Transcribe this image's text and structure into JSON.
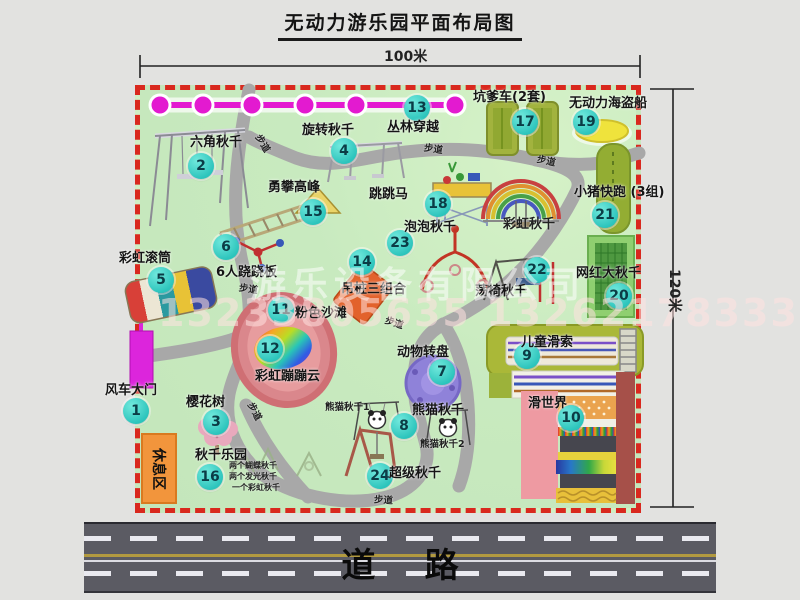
{
  "title": "无动力游乐园平面布局图",
  "dimensions": {
    "width_label": "100米",
    "height_label": "120米"
  },
  "watermark": {
    "company": "游乐设备有限公司",
    "phone": "13233805635 13262178333"
  },
  "road": {
    "label": "道 路"
  },
  "rest_area": {
    "label": "休息区"
  },
  "colors": {
    "border_red": "#d9281e",
    "park_green": "#c8eabf",
    "badge_cyan": "#2cc4bc",
    "path_gray": "#a8a8a8",
    "zipline_magenta": "#e31ad0",
    "gate_magenta": "#dc25dc",
    "rest_area_orange": "#f2953c",
    "road_gray": "#5b5b63"
  },
  "park": {
    "attractions": [
      {
        "num": 1,
        "label": "风车大门",
        "bx": 136,
        "by": 411,
        "lx": 105,
        "ly": 379
      },
      {
        "num": 2,
        "label": "六角秋千",
        "bx": 201,
        "by": 166,
        "lx": 190,
        "ly": 131
      },
      {
        "num": 3,
        "label": "樱花树",
        "bx": 216,
        "by": 422,
        "lx": 186,
        "ly": 391
      },
      {
        "num": 4,
        "label": "旋转秋千",
        "bx": 344,
        "by": 151,
        "lx": 302,
        "ly": 119
      },
      {
        "num": 5,
        "label": "彩虹滚筒",
        "bx": 161,
        "by": 280,
        "lx": 119,
        "ly": 247
      },
      {
        "num": 6,
        "label": "6人跷跷板",
        "bx": 226,
        "by": 247,
        "lx": 216,
        "ly": 261
      },
      {
        "num": 7,
        "label": "动物转盘",
        "bx": 442,
        "by": 372,
        "lx": 397,
        "ly": 341
      },
      {
        "num": 8,
        "label": "熊猫秋千",
        "bx": 404,
        "by": 426,
        "lx": 412,
        "ly": 399
      },
      {
        "num": 9,
        "label": "儿童滑索",
        "bx": 527,
        "by": 356,
        "lx": 521,
        "ly": 331
      },
      {
        "num": 10,
        "label": "滑世界",
        "bx": 571,
        "by": 418,
        "lx": 528,
        "ly": 392
      },
      {
        "num": 11,
        "label": "粉色沙滩",
        "bx": 281,
        "by": 310,
        "lx": 295,
        "ly": 302
      },
      {
        "num": 12,
        "label": "彩虹蹦蹦云",
        "bx": 270,
        "by": 349,
        "lx": 255,
        "ly": 365
      },
      {
        "num": 13,
        "label": "丛林穿越",
        "bx": 417,
        "by": 108,
        "lx": 387,
        "ly": 116
      },
      {
        "num": 14,
        "label": "吊桩三组合",
        "bx": 362,
        "by": 262,
        "lx": 341,
        "ly": 278
      },
      {
        "num": 15,
        "label": "勇攀高峰",
        "bx": 313,
        "by": 212,
        "lx": 268,
        "ly": 176
      },
      {
        "num": 16,
        "label": "秋千乐园",
        "bx": 210,
        "by": 477,
        "lx": 195,
        "ly": 444
      },
      {
        "num": 17,
        "label": "坑爹车(2套)",
        "bx": 525,
        "by": 122,
        "lx": 473,
        "ly": 86
      },
      {
        "num": 18,
        "label": "跳跳马",
        "bx": 438,
        "by": 204,
        "lx": 369,
        "ly": 183
      },
      {
        "num": 19,
        "label": "无动力海盗船",
        "bx": 586,
        "by": 122,
        "lx": 569,
        "ly": 92
      },
      {
        "num": 20,
        "label": "网红大秋千",
        "bx": 619,
        "by": 296,
        "lx": 576,
        "ly": 262
      },
      {
        "num": 21,
        "label": "小猪快跑 (3组)",
        "bx": 605,
        "by": 215,
        "lx": 574,
        "ly": 181
      },
      {
        "num": 22,
        "label": "荡椅秋千",
        "bx": 537,
        "by": 270,
        "lx": 475,
        "ly": 280
      },
      {
        "num": 23,
        "label": "泡泡秋千",
        "bx": 400,
        "by": 243,
        "lx": 404,
        "ly": 216
      },
      {
        "num": 24,
        "label": "超级秋千",
        "bx": 380,
        "by": 476,
        "lx": 389,
        "ly": 462
      }
    ],
    "extra_labels": [
      {
        "text": "彩虹秋千",
        "x": 503,
        "y": 213,
        "rot": 0,
        "fs": 13
      },
      {
        "text": "熊猫秋千1",
        "x": 325,
        "y": 399,
        "rot": 0,
        "fs": 9.5
      },
      {
        "text": "熊猫秋千2",
        "x": 420,
        "y": 436,
        "rot": 0,
        "fs": 9.5
      },
      {
        "text": "两个蝴蝶秋千",
        "x": 229,
        "y": 460,
        "rot": 0,
        "fs": 8
      },
      {
        "text": "两个发光秋千",
        "x": 229,
        "y": 471,
        "rot": 0,
        "fs": 8
      },
      {
        "text": "一个彩虹秋千",
        "x": 232,
        "y": 482,
        "rot": 0,
        "fs": 8
      },
      {
        "text": "步道",
        "x": 254,
        "y": 136,
        "rot": 58,
        "fs": 9.5
      },
      {
        "text": "步道",
        "x": 424,
        "y": 141,
        "rot": 8,
        "fs": 9.5
      },
      {
        "text": "步道",
        "x": 537,
        "y": 153,
        "rot": 12,
        "fs": 9.5
      },
      {
        "text": "步道",
        "x": 239,
        "y": 281,
        "rot": 8,
        "fs": 9.5
      },
      {
        "text": "步道",
        "x": 385,
        "y": 315,
        "rot": 18,
        "fs": 9.5
      },
      {
        "text": "步道",
        "x": 246,
        "y": 404,
        "rot": 62,
        "fs": 9.5
      },
      {
        "text": "步道",
        "x": 374,
        "y": 492,
        "rot": 4,
        "fs": 9.5
      }
    ]
  }
}
